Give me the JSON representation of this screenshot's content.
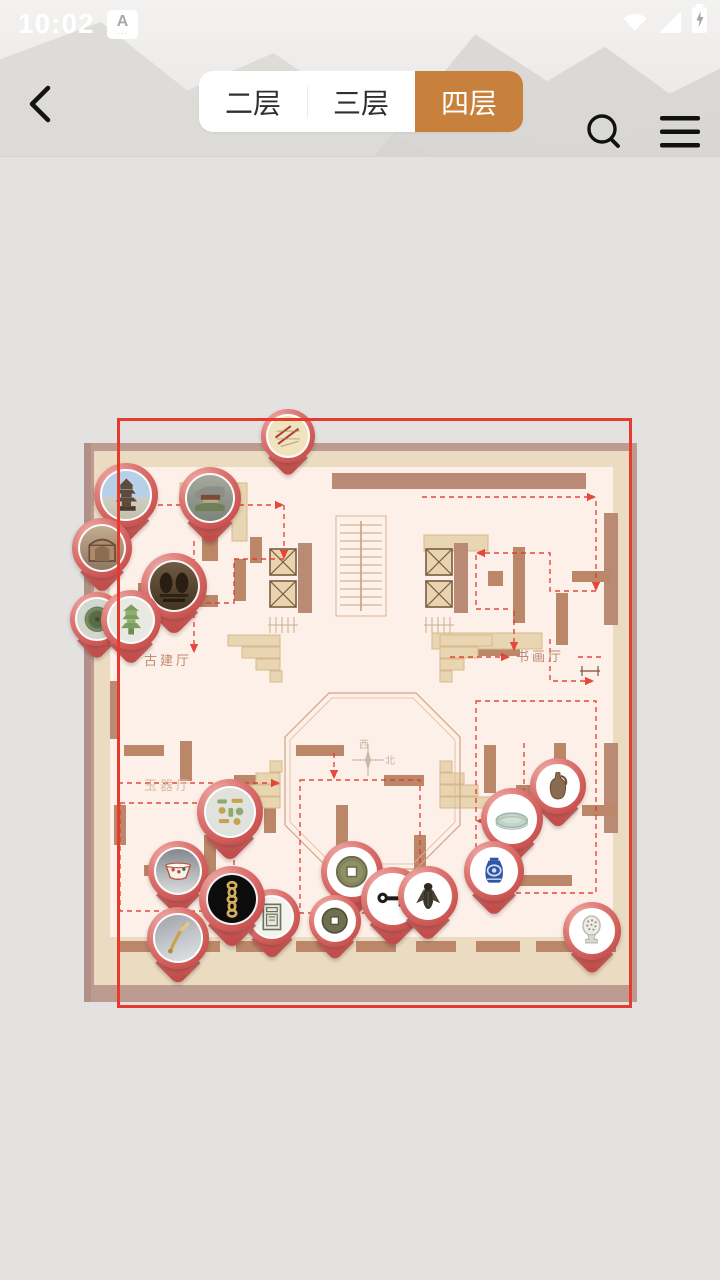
{
  "status_bar": {
    "time": "10:02",
    "ime_badge": "A",
    "ime_dots": "...",
    "icons": [
      "wifi-icon",
      "signal-icon",
      "battery-charging-icon"
    ]
  },
  "header": {
    "back_icon": "chevron-left",
    "search_icon": "magnifier",
    "menu_icon": "hamburger",
    "accent_color": "#c8813c",
    "tabs": [
      {
        "label": "二层",
        "selected": false
      },
      {
        "label": "三层",
        "selected": false
      },
      {
        "label": "四层",
        "selected": true
      }
    ]
  },
  "map": {
    "halls": [
      {
        "name": "古建厅"
      },
      {
        "name": "书画厅"
      },
      {
        "name": "玉器厅"
      }
    ],
    "compass": {
      "west": "西",
      "north": "北"
    },
    "colors": {
      "frame": "#bd9b90",
      "wall": "#eadbc1",
      "room": "#fdf0e8",
      "block": "#bc8668",
      "route": "#e23b30",
      "viewport": "#e63a2e",
      "pin": "#d4605c"
    },
    "pins": [
      {
        "id": "ancient-map-scroll",
        "kind": "scroll",
        "x": 288,
        "y": 436,
        "size": 54
      },
      {
        "id": "wooden-pagoda",
        "kind": "pagoda",
        "x": 126,
        "y": 495,
        "size": 64
      },
      {
        "id": "cliff-temple",
        "kind": "temple",
        "x": 210,
        "y": 498,
        "size": 62
      },
      {
        "id": "temple-mural",
        "kind": "mural",
        "x": 102,
        "y": 548,
        "size": 60
      },
      {
        "id": "bronze-mirror",
        "kind": "mirror",
        "x": 97,
        "y": 619,
        "size": 54
      },
      {
        "id": "grotto-caves",
        "kind": "grotto",
        "x": 174,
        "y": 586,
        "size": 66
      },
      {
        "id": "glazed-tower-model",
        "kind": "tower",
        "x": 131,
        "y": 620,
        "size": 60
      },
      {
        "id": "jade-ornament-set",
        "kind": "jade",
        "x": 230,
        "y": 812,
        "size": 66
      },
      {
        "id": "porcelain-bowl",
        "kind": "bowl",
        "x": 178,
        "y": 871,
        "size": 60
      },
      {
        "id": "banknote-plate",
        "kind": "banknote",
        "x": 272,
        "y": 917,
        "size": 56
      },
      {
        "id": "gold-chain",
        "kind": "chain",
        "x": 232,
        "y": 899,
        "size": 66
      },
      {
        "id": "jade-hairpin",
        "kind": "hairpin",
        "x": 178,
        "y": 938,
        "size": 62
      },
      {
        "id": "bronze-coin-large",
        "kind": "coin",
        "x": 352,
        "y": 872,
        "size": 62
      },
      {
        "id": "bronze-coin-small",
        "kind": "coin2",
        "x": 335,
        "y": 921,
        "size": 52
      },
      {
        "id": "bronze-key",
        "kind": "key",
        "x": 393,
        "y": 899,
        "size": 64
      },
      {
        "id": "bronze-cicada",
        "kind": "cicada",
        "x": 428,
        "y": 896,
        "size": 60
      },
      {
        "id": "pottery-vase",
        "kind": "vase",
        "x": 558,
        "y": 786,
        "size": 56
      },
      {
        "id": "celadon-plate",
        "kind": "plate",
        "x": 512,
        "y": 819,
        "size": 62
      },
      {
        "id": "blue-white-jar",
        "kind": "bluejar",
        "x": 494,
        "y": 871,
        "size": 60
      },
      {
        "id": "white-censer",
        "kind": "censer",
        "x": 592,
        "y": 931,
        "size": 58
      }
    ]
  }
}
